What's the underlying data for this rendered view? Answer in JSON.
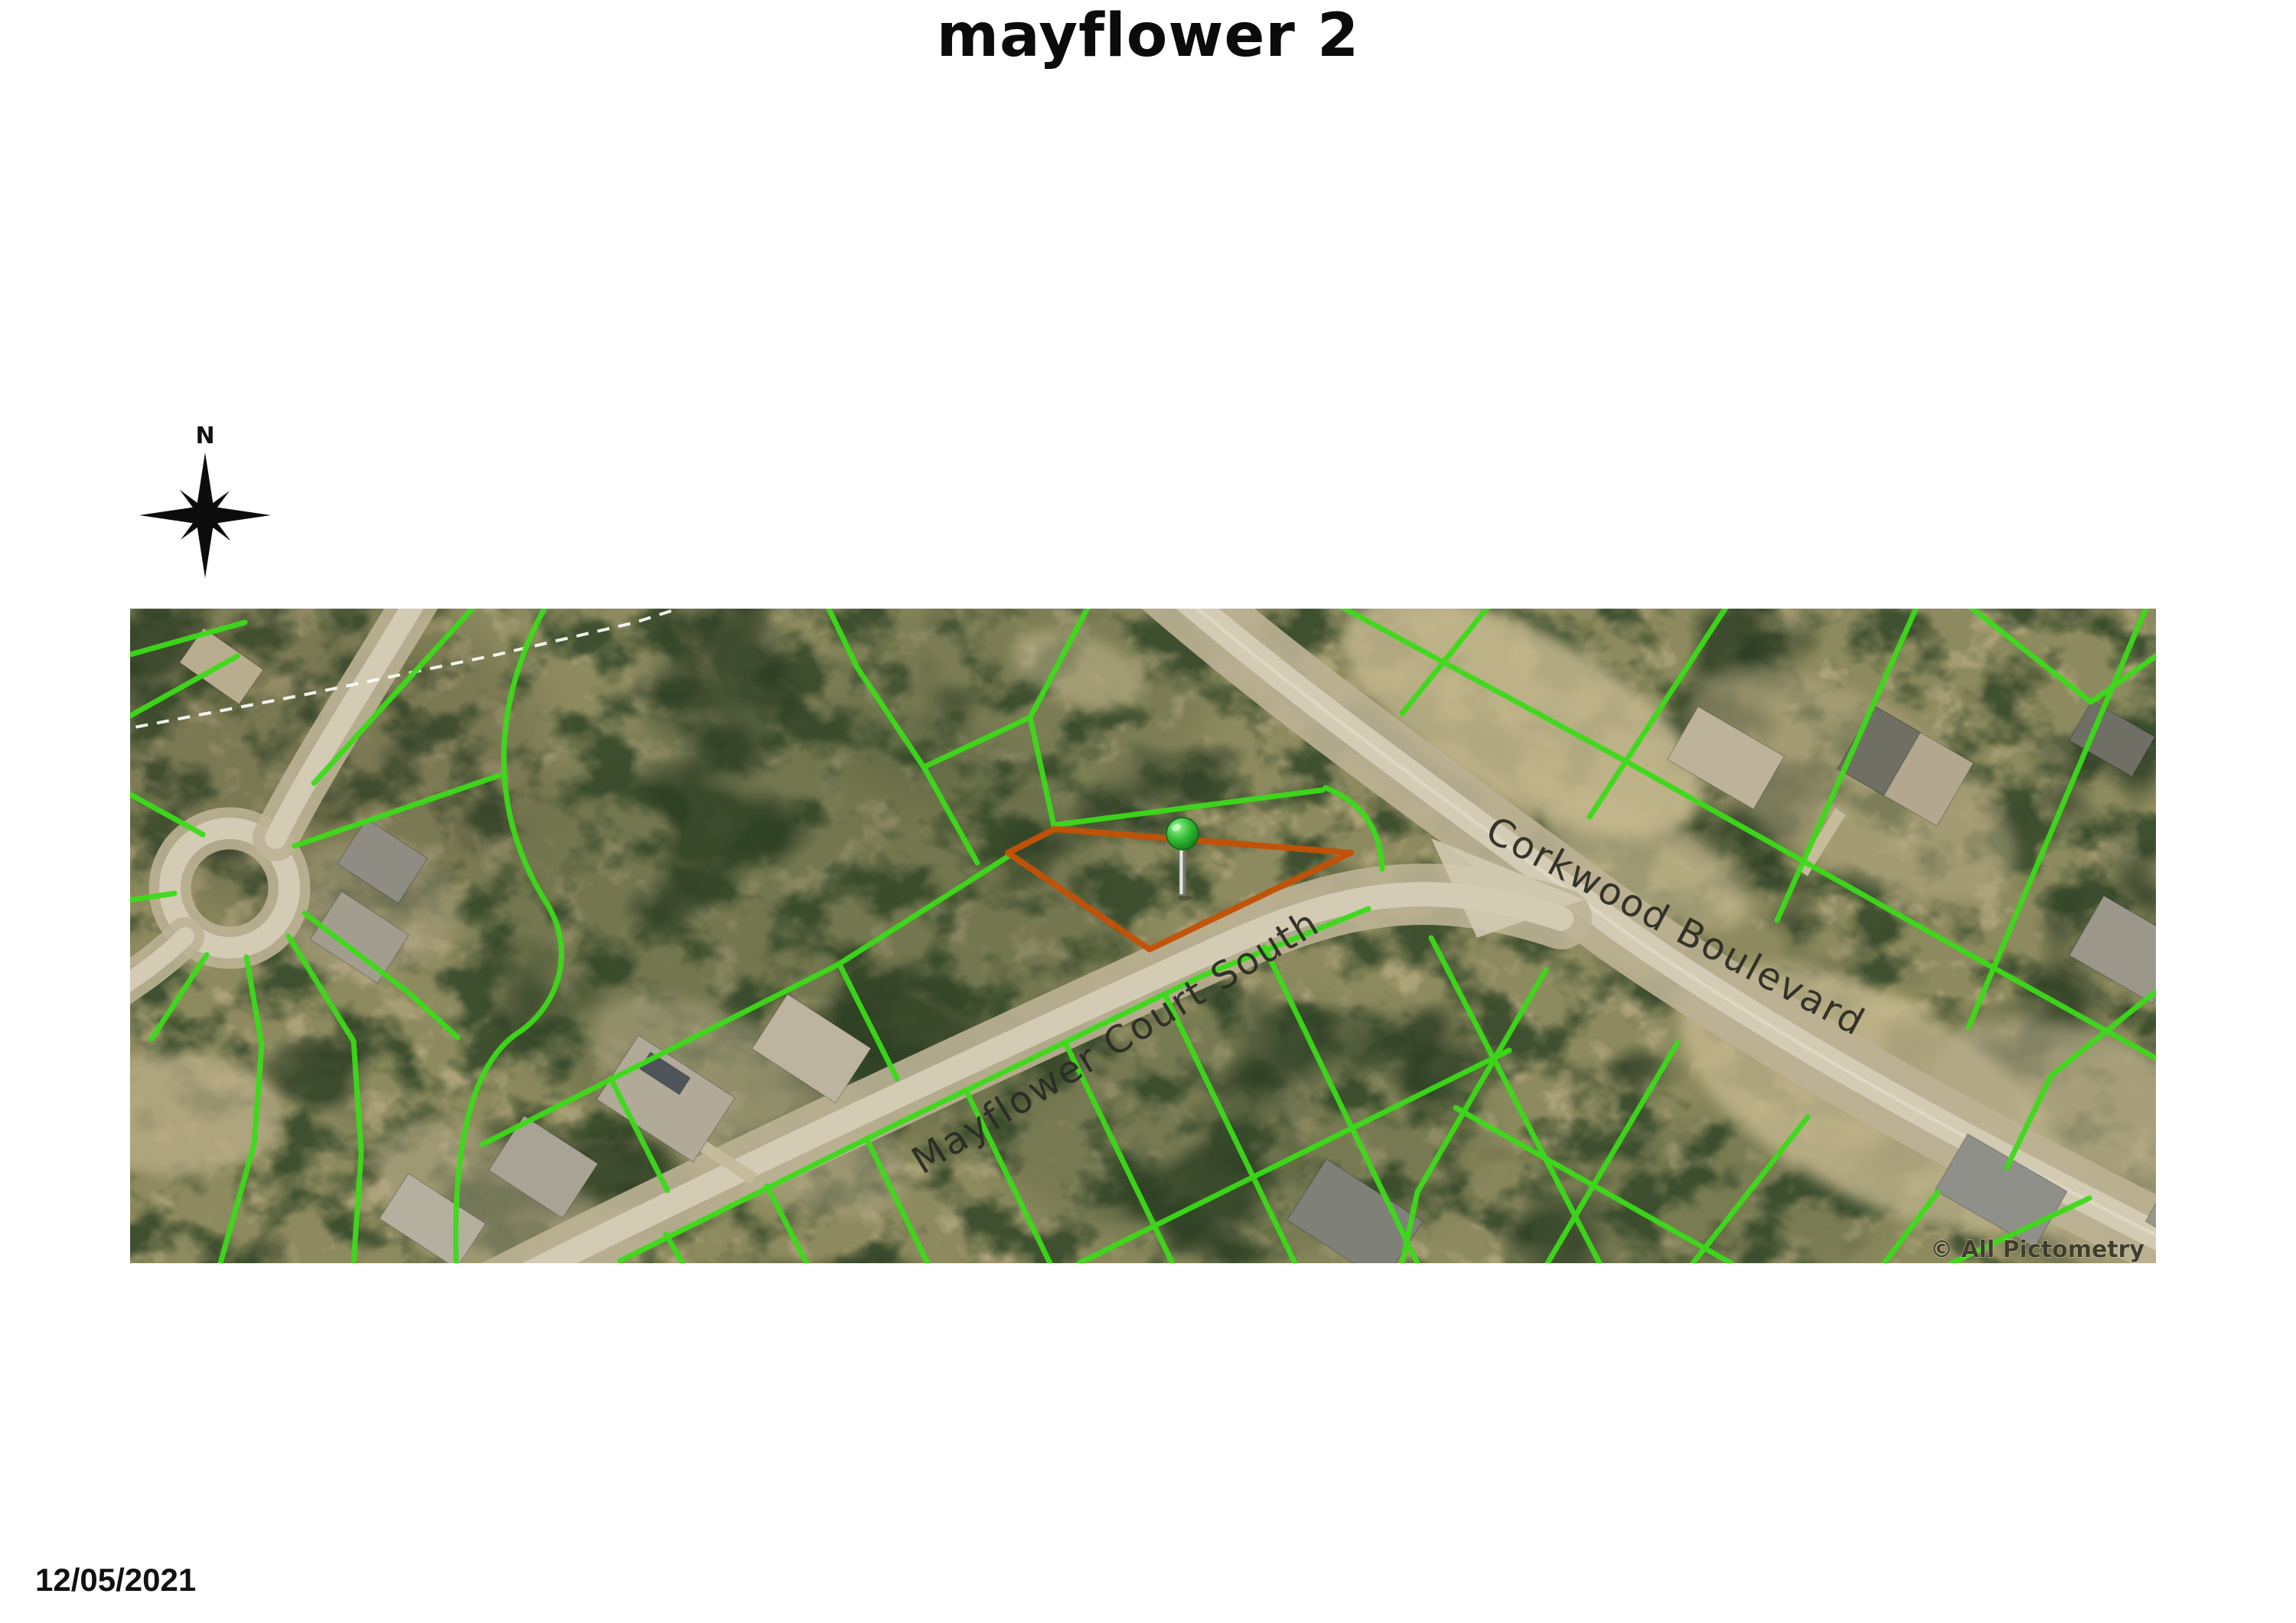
{
  "page": {
    "title": "mayflower 2",
    "date": "12/05/2021"
  },
  "compass": {
    "label": "N"
  },
  "map": {
    "street_labels": [
      {
        "text": "Corkwood Boulevard"
      },
      {
        "text": "Mayflower Court South"
      }
    ],
    "attribution": "© All Pictometry",
    "subject_parcel_points": "1147,319 1208,288 1595,319 1332,445",
    "colors": {
      "parcel-line": "#3cdb1a",
      "subject-parcel": "#c25206",
      "road-pavement": "#d3cbb4",
      "road-corridor": "#bdb295",
      "pin-green": "#2eb834",
      "terrain-base": "#8d8a5f",
      "tree-dark": "#3b4d2d",
      "scrub-light": "#b3a77e",
      "label-text": "#2b2b24"
    }
  }
}
